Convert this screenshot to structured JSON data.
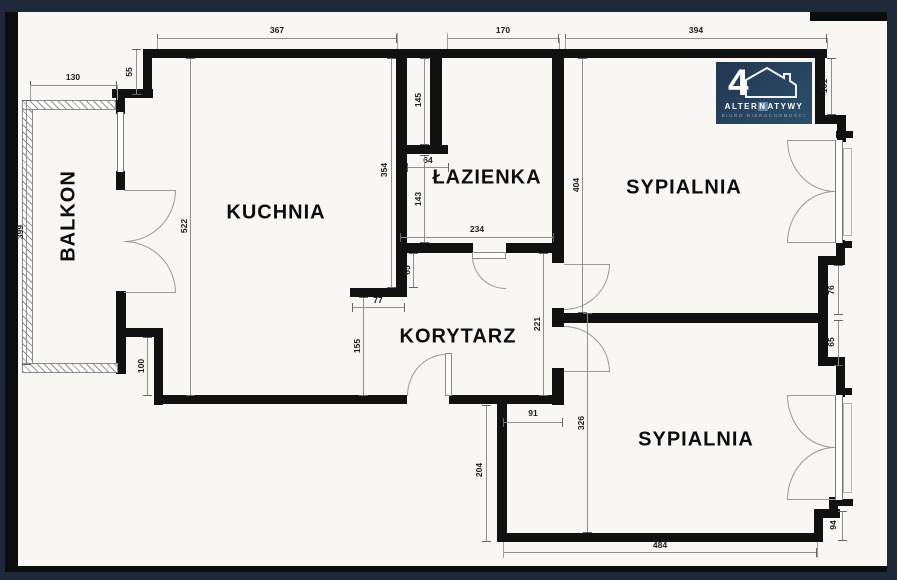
{
  "colors": {
    "background_navy": "#1f2839",
    "paper": "#f8f7f4",
    "wall": "#111111",
    "dimension_line": "#8f8f8f",
    "logo_navy": "#2c4f6c"
  },
  "rooms": {
    "balkon": "BALKON",
    "kuchnia": "KUCHNIA",
    "lazienka": "ŁAZIENKA",
    "sypialnia1": "SYPIALNIA",
    "korytarz": "KORYTARZ",
    "sypialnia2": "SYPIALNIA"
  },
  "dims": {
    "top_kitchen": "367",
    "top_bathroom": "170",
    "top_bedroom": "394",
    "balcony_top": "130",
    "step_left": "55",
    "balcony_left": "399",
    "kitchen_left": "522",
    "kitchen_right": "354",
    "duct": "64",
    "bath_upper_left": "145",
    "bath_lower_left": "143",
    "bath_width": "234",
    "bath_stub_gap": "65",
    "stub": "77",
    "corridor_left": "155",
    "kitchen_step": "100",
    "bedroom1_height": "404",
    "corridor_right": "221",
    "bedroom2_height": "326",
    "entry_wall": "91",
    "below_corridor": "204",
    "bedroom2_width": "484",
    "corner_step": "94",
    "bedroom1_right": "101",
    "pier_upper": "76",
    "pier_lower": "65"
  },
  "logo": {
    "number": "4",
    "name_pre": "ALTER",
    "name_boxed": "N",
    "name_post": "ATYWY",
    "tagline": "BIURO NIERUCHOMOŚCI"
  }
}
